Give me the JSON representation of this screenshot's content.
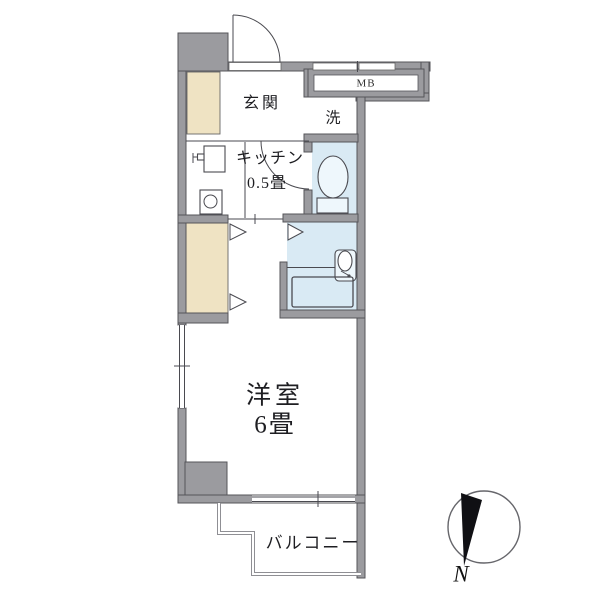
{
  "plan": {
    "entrance_label": "玄関",
    "kitchen_label": "キッチン",
    "kitchen_size": "0.5畳",
    "washer_label": "洗",
    "meter_box_label": "MB",
    "main_room_label": "洋室",
    "main_room_size": "6畳",
    "balcony_label": "バルコニー"
  },
  "compass": {
    "north_label": "N"
  },
  "colors": {
    "wall": "#9b9b9f",
    "wall_outline": "#55555a",
    "closet_wood": "#efe3c3",
    "wet_area_blue": "#d9eaf4",
    "line": "#4a4a50",
    "background": "#ffffff",
    "compass_needle": "#101014"
  }
}
